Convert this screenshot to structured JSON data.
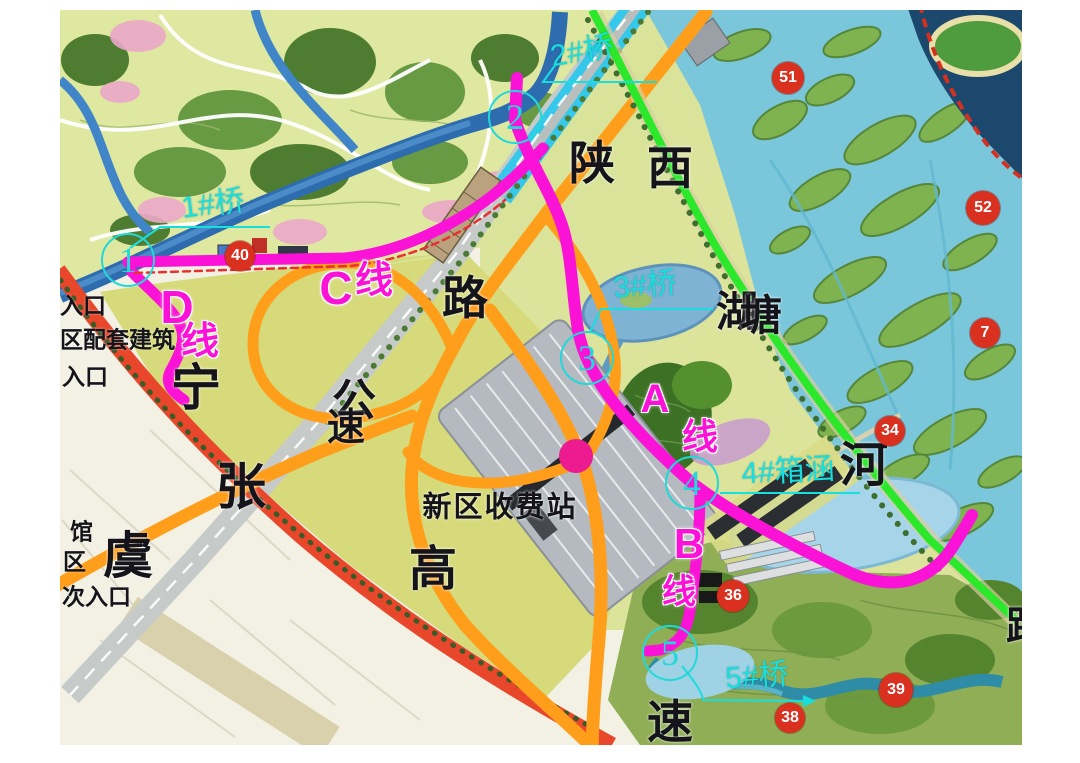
{
  "map": {
    "colors": {
      "route_magenta": "#fb12d7",
      "label_cyan": "#19dede",
      "road_orange": "#ff9e1b",
      "road_red": "#e8472b",
      "road_cyan": "#35c8ea",
      "line_green": "#2be82b",
      "marker_red": "#d93020",
      "dot_pink": "#ec1b90"
    },
    "black_labels": [
      {
        "text": "陕",
        "x": 592,
        "y": 163,
        "s": 46
      },
      {
        "text": "西",
        "x": 670,
        "y": 168,
        "s": 46
      },
      {
        "text": "路",
        "x": 465,
        "y": 298,
        "s": 46
      },
      {
        "text": "公",
        "x": 354,
        "y": 401,
        "s": 44
      },
      {
        "text": "速",
        "x": 346,
        "y": 428,
        "s": 38
      },
      {
        "text": "高",
        "x": 433,
        "y": 570,
        "s": 48
      },
      {
        "text": "速",
        "x": 670,
        "y": 722,
        "s": 46
      },
      {
        "text": "宁",
        "x": 196,
        "y": 388,
        "s": 50
      },
      {
        "text": "张",
        "x": 241,
        "y": 487,
        "s": 50
      },
      {
        "text": "虞",
        "x": 128,
        "y": 556,
        "s": 50
      },
      {
        "text": "湖",
        "x": 737,
        "y": 312,
        "s": 42
      },
      {
        "text": "塘",
        "x": 761,
        "y": 316,
        "s": 42
      },
      {
        "text": "河",
        "x": 864,
        "y": 466,
        "s": 48
      },
      {
        "text": "新区收费站",
        "x": 500,
        "y": 508,
        "s": 29,
        "ls": 2
      },
      {
        "text": "路",
        "x": 1026,
        "y": 627,
        "s": 40
      }
    ],
    "side_labels": [
      {
        "text": "入口",
        "x": 60,
        "y": 306
      },
      {
        "text": "区配套建筑",
        "x": 60,
        "y": 340
      },
      {
        "text": "入口",
        "x": 62,
        "y": 377
      },
      {
        "text": "馆",
        "x": 70,
        "y": 532
      },
      {
        "text": "区",
        "x": 63,
        "y": 562
      },
      {
        "text": "次入口",
        "x": 62,
        "y": 597
      }
    ],
    "route_chars": [
      {
        "text": "C",
        "x": 336,
        "y": 288,
        "s": 46
      },
      {
        "text": "线",
        "x": 374,
        "y": 281,
        "s": 38
      },
      {
        "text": "D",
        "x": 177,
        "y": 307,
        "s": 46
      },
      {
        "text": "线",
        "x": 200,
        "y": 342,
        "s": 38
      },
      {
        "text": "A",
        "x": 655,
        "y": 399,
        "s": 40
      },
      {
        "text": "线",
        "x": 700,
        "y": 437,
        "s": 36
      },
      {
        "text": "B",
        "x": 689,
        "y": 544,
        "s": 42
      },
      {
        "text": "线",
        "x": 679,
        "y": 592,
        "s": 34
      }
    ],
    "bridge_labels": [
      {
        "text": "1#桥",
        "x": 213,
        "y": 205,
        "s": 30,
        "rot": -7
      },
      {
        "text": "2#桥",
        "x": 582,
        "y": 52,
        "s": 30,
        "rot": -10
      },
      {
        "text": "3#桥",
        "x": 645,
        "y": 286,
        "s": 30,
        "rot": -5
      },
      {
        "text": "4#箱涵",
        "x": 788,
        "y": 472,
        "s": 30,
        "rot": -3
      },
      {
        "text": "5#桥",
        "x": 757,
        "y": 677,
        "s": 30,
        "rot": -4
      }
    ],
    "node_circles": [
      {
        "n": "1",
        "x": 128,
        "y": 260,
        "d": 50
      },
      {
        "n": "2",
        "x": 515,
        "y": 117,
        "d": 50
      },
      {
        "n": "3",
        "x": 587,
        "y": 358,
        "d": 50
      },
      {
        "n": "4",
        "x": 692,
        "y": 483,
        "d": 50
      },
      {
        "n": "5",
        "x": 670,
        "y": 653,
        "d": 52
      }
    ],
    "red_markers": [
      {
        "n": "40",
        "x": 240,
        "y": 256,
        "d": 30
      },
      {
        "n": "51",
        "x": 788,
        "y": 78,
        "d": 32
      },
      {
        "n": "52",
        "x": 983,
        "y": 208,
        "d": 34
      },
      {
        "n": "7",
        "x": 985,
        "y": 333,
        "d": 30
      },
      {
        "n": "34",
        "x": 890,
        "y": 431,
        "d": 30
      },
      {
        "n": "36",
        "x": 733,
        "y": 596,
        "d": 32
      },
      {
        "n": "39",
        "x": 896,
        "y": 690,
        "d": 34
      },
      {
        "n": "38",
        "x": 790,
        "y": 718,
        "d": 30
      }
    ],
    "dot": {
      "x": 576,
      "y": 456,
      "d": 34
    }
  }
}
